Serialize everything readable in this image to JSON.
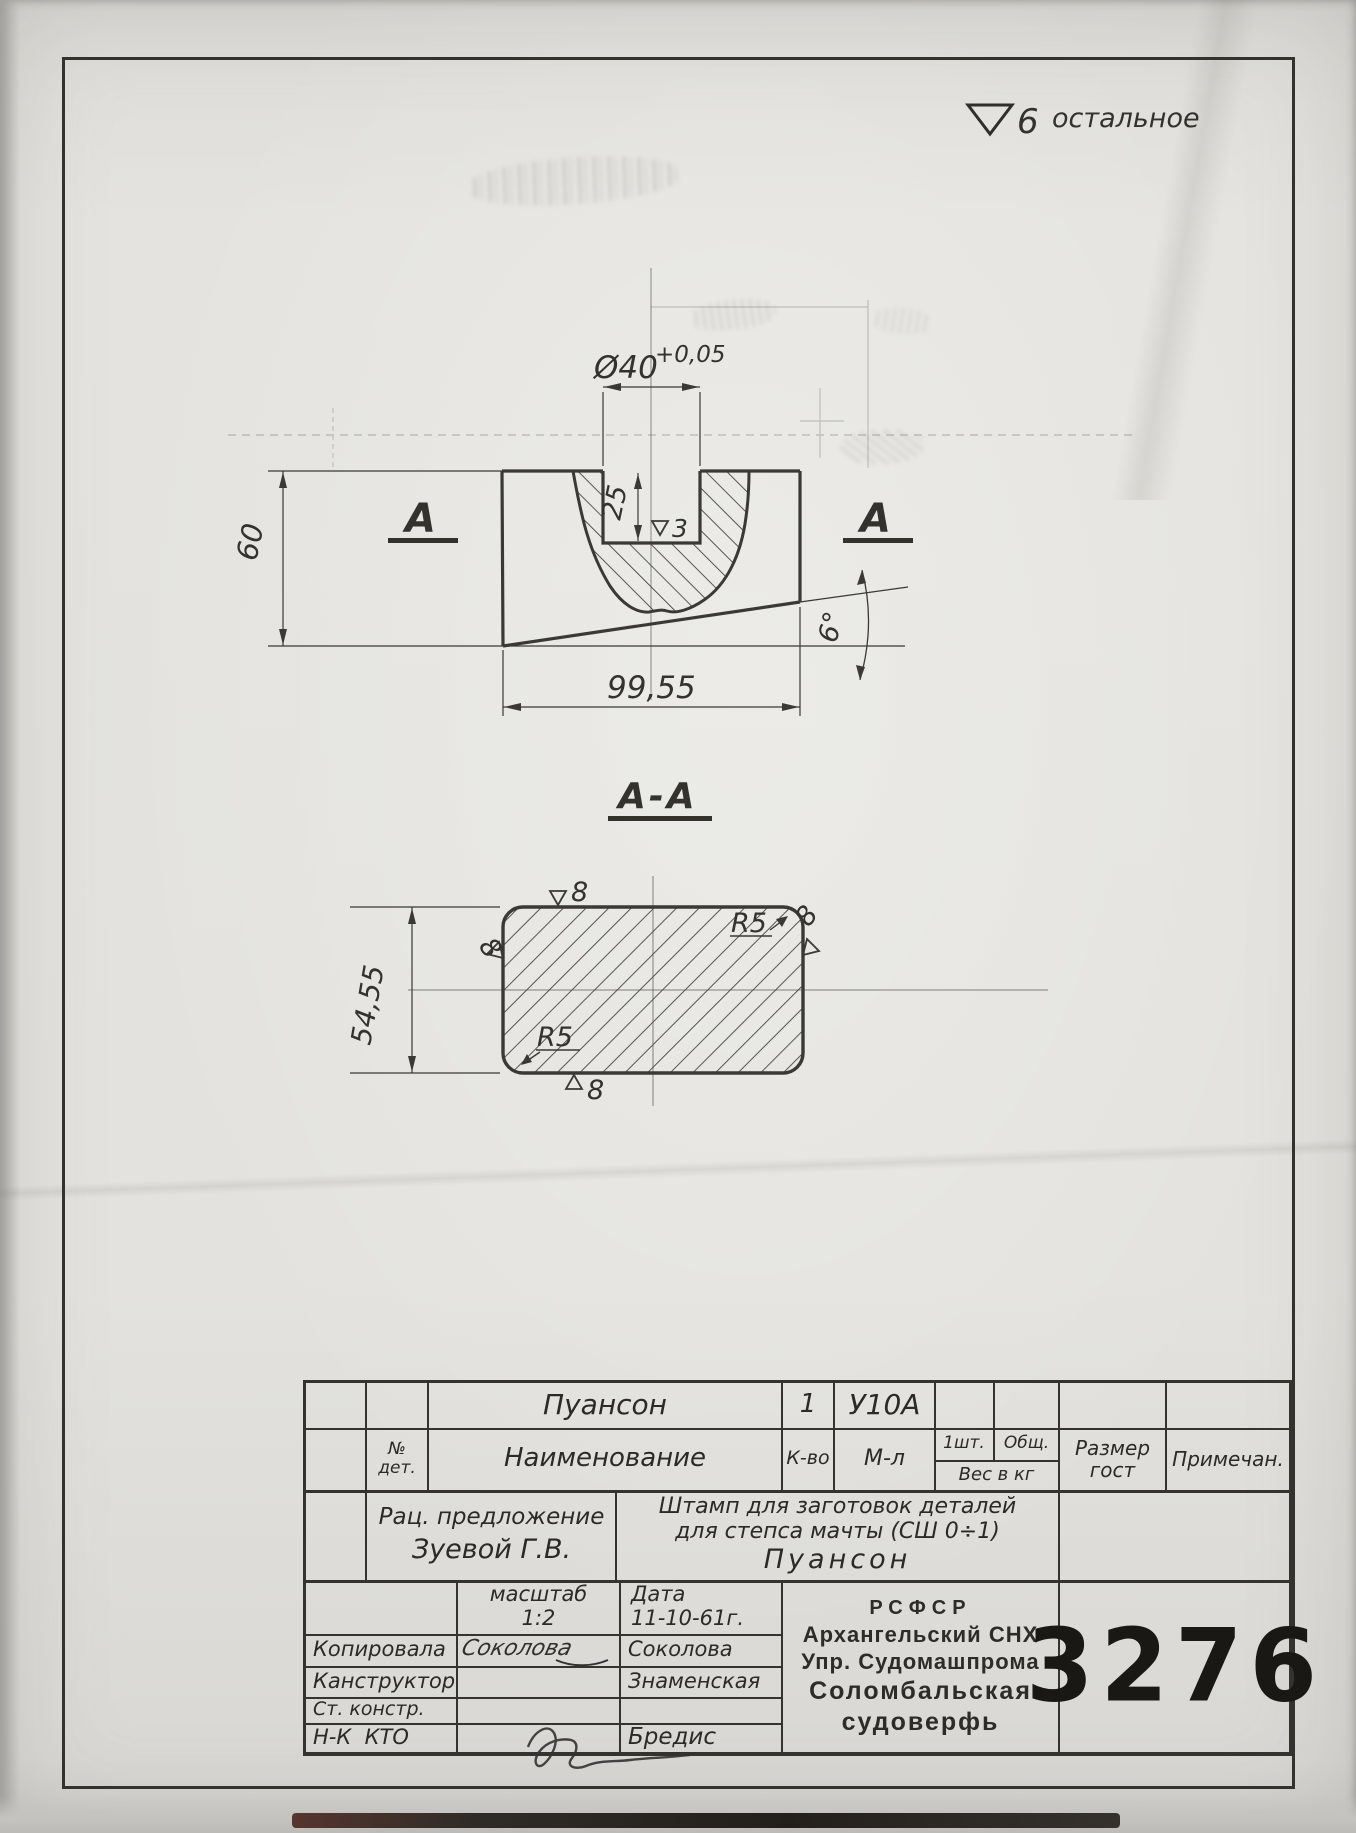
{
  "sheet": {
    "finish_note": {
      "grade": "6",
      "text": "остальное"
    },
    "front_view": {
      "label_a_left": "А",
      "label_a_right": "А",
      "dia": "Ø40",
      "dia_tol": "+0,05",
      "depth": "25",
      "slot_finish": "3",
      "height": "60",
      "width": "99,55",
      "angle": "6°"
    },
    "section_view": {
      "title": "А-А",
      "height": "54,55",
      "r_top": "R5",
      "r_bottom": "R5",
      "finish_top": "8",
      "finish_left": "8",
      "finish_right": "8",
      "finish_bottom": "8"
    },
    "title_block": {
      "part": {
        "name": "Пуансон",
        "qty": "1",
        "material": "У10А"
      },
      "headers": {
        "det_no_1": "№",
        "det_no_2": "дет.",
        "name": "Наименование",
        "qty": "К-во",
        "material": "М-л",
        "per_piece": "1шт.",
        "total": "Общ.",
        "weight": "Вес в кг",
        "size_gost_1": "Размер",
        "size_gost_2": "гост",
        "note": "Примечан."
      },
      "proposal_line1": "Рац. предложение",
      "proposal_line2": "Зуевой Г.В.",
      "title_line1": "Штамп для заготовок деталей",
      "title_line2": "для степса мачты (СШ 0÷1)",
      "title_line3": "Пуансон",
      "scale_label": "масштаб",
      "scale_value": "1:2",
      "date_label": "Дата",
      "date_value": "11-10-61г.",
      "rows": [
        {
          "label": "Копировала",
          "signature": "Соколова",
          "name": "Соколова"
        },
        {
          "label": "Канструктор",
          "name": "Знаменская"
        },
        {
          "label": "Ст. констр."
        },
        {
          "label": "Н-К  КТО",
          "name": "Бредис"
        }
      ],
      "org_line1": "РСФСР",
      "org_line2": "Архангельский СНХ",
      "org_line3": "Упр. Судомашпрома",
      "org_line4": "Соломбальская",
      "org_line5": "судоверфь",
      "number": "3276"
    }
  }
}
